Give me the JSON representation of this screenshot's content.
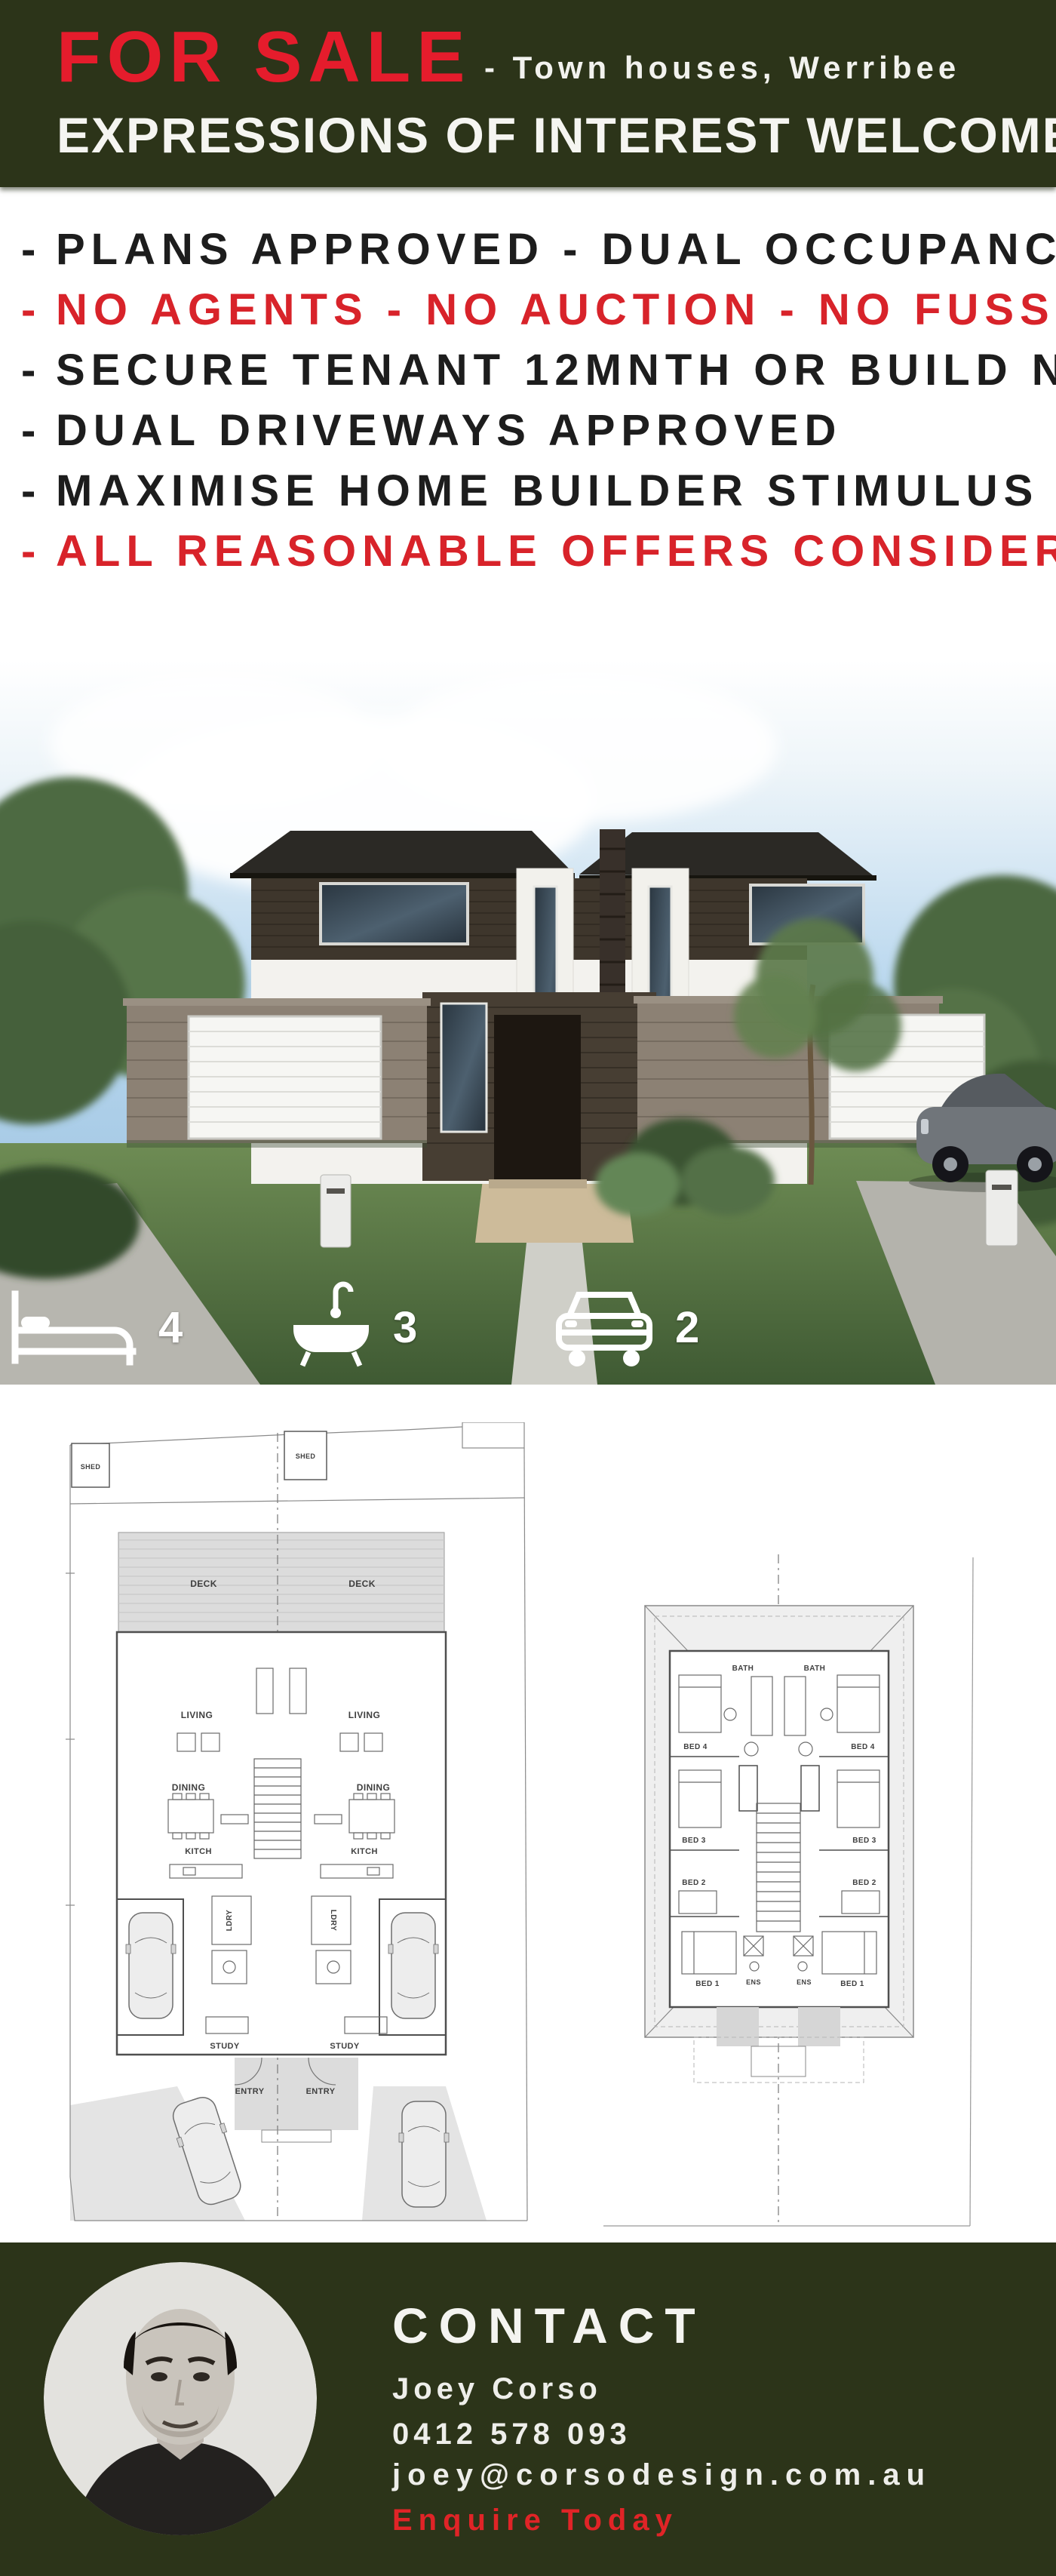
{
  "colors": {
    "olive_green": "#2c3419",
    "sale_red": "#e51c2c",
    "bullet_red": "#d8232a",
    "bullet_black": "#1d1d1d",
    "plan_ink": "#4f4f4f",
    "cta_red": "#e02427"
  },
  "header": {
    "title": "FOR SALE",
    "subtitle": "- Town houses, Werribee",
    "line2": "EXPRESSIONS OF INTEREST WELCOME"
  },
  "bullets": {
    "dash": "-",
    "items": [
      {
        "text": "PLANS APPROVED - DUAL OCCUPANCY",
        "color": "#1d1d1d"
      },
      {
        "text": "NO AGENTS - NO AUCTION - NO FUSS",
        "color": "#d8232a"
      },
      {
        "text": "SECURE TENANT 12MNTH OR BUILD NOW",
        "color": "#1d1d1d"
      },
      {
        "text": "DUAL DRIVEWAYS APPROVED",
        "color": "#1d1d1d"
      },
      {
        "text": "MAXIMISE HOME BUILDER STIMULUS",
        "color": "#1d1d1d"
      },
      {
        "text": "ALL REASONABLE OFFERS CONSIDERED",
        "color": "#d8232a"
      }
    ]
  },
  "property_stats": [
    {
      "icon": "bed-icon",
      "value": "4"
    },
    {
      "icon": "bath-icon",
      "value": "3"
    },
    {
      "icon": "car-icon",
      "value": "2"
    }
  ],
  "plans": {
    "ground": {
      "shed1": "SHED",
      "shed2": "SHED",
      "deck1": "DECK",
      "deck2": "DECK",
      "living1": "LIVING",
      "living2": "LIVING",
      "dining1": "DINING",
      "dining2": "DINING",
      "kitch1": "KITCH",
      "kitch2": "KITCH",
      "ldry1": "LDRY",
      "ldry2": "LDRY",
      "study1": "STUDY",
      "study2": "STUDY",
      "entry1": "ENTRY",
      "entry2": "ENTRY"
    },
    "first": {
      "bath1": "BATH",
      "bath2": "BATH",
      "bed4a": "BED 4",
      "bed4b": "BED 4",
      "bed3a": "BED 3",
      "bed3b": "BED 3",
      "bed2a": "BED 2",
      "bed2b": "BED 2",
      "bed1a": "BED 1",
      "bed1b": "BED 1",
      "ens1": "ENS",
      "ens2": "ENS"
    }
  },
  "contact": {
    "heading": "CONTACT",
    "name": "Joey Corso",
    "phone": "0412 578 093",
    "email": "joey@corsodesign.com.au",
    "cta": "Enquire Today"
  }
}
